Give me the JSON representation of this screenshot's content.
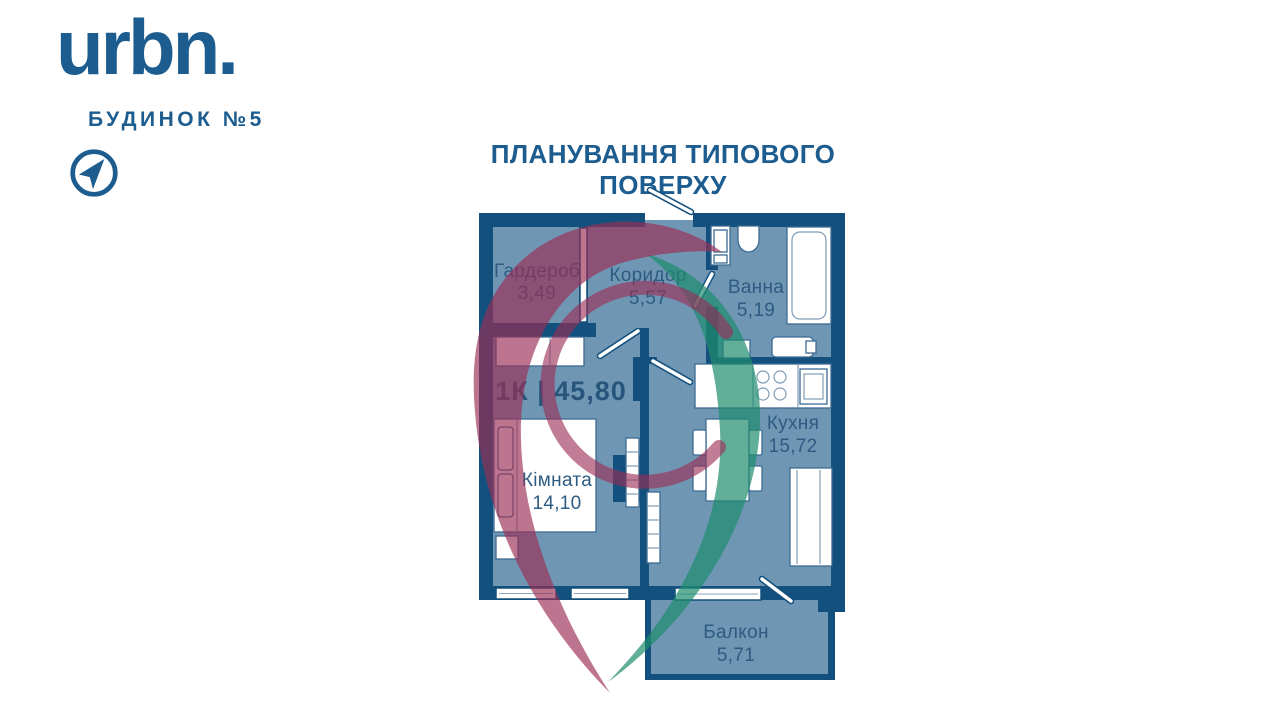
{
  "brand": {
    "logo": "urbn.",
    "building": "БУДИНОК №5"
  },
  "page_title": "ПЛАНУВАННЯ ТИПОВОГО ПОВЕРХУ",
  "floor_plan": {
    "apartment_label": "1К | 45,80",
    "rooms": {
      "garderob": {
        "name": "Гардероб",
        "area": "3,49"
      },
      "koridor": {
        "name": "Коридор",
        "area": "5,57"
      },
      "vanna": {
        "name": "Ванна",
        "area": "5,19"
      },
      "kimnata": {
        "name": "Кімната",
        "area": "14,10"
      },
      "kukhnya": {
        "name": "Кухня",
        "area": "15,72"
      },
      "balkon": {
        "name": "Балкон",
        "area": "5,71"
      }
    }
  },
  "colors": {
    "wall": "#14507d",
    "floor": "#6f97b4",
    "accent": "#1c5c8e",
    "label": "#2d5b82",
    "swirl_purple": "#9b2d55",
    "swirl_teal": "#1e8c6e"
  }
}
